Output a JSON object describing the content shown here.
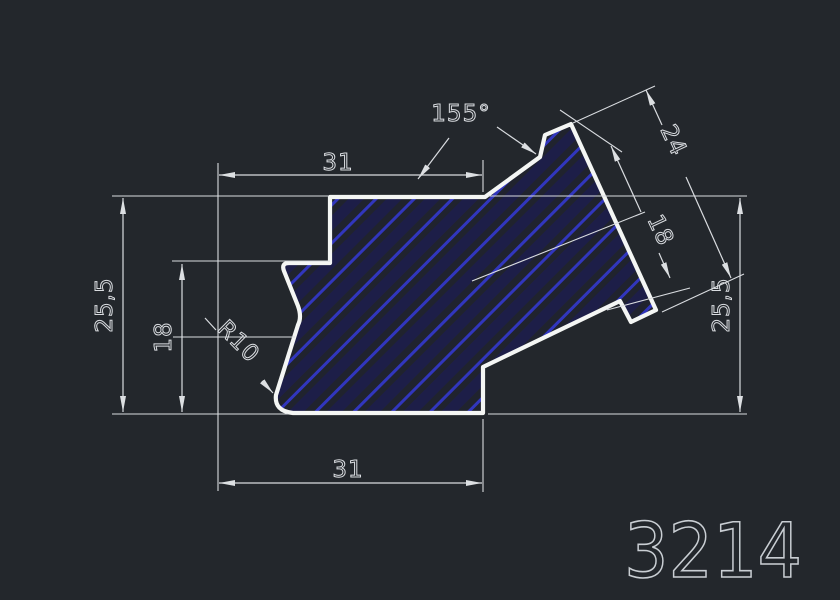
{
  "drawing": {
    "part_number": "3214",
    "annotations": {
      "top_width": "31",
      "bottom_width": "31",
      "left_height": "25,5",
      "right_height": "25,5",
      "notch_height": "18",
      "flange_outer_length": "24",
      "flange_inner_length": "18",
      "bend_angle": "155°",
      "fillet_radius": "R10"
    },
    "colors": {
      "background": "#23272c",
      "profile_outline": "#f4f6f4",
      "dimension_lines": "#d9dce0",
      "hatch_line": "#3136bd",
      "hatch_band": "#1d1e48",
      "part_number_text": "#c9ced3"
    }
  }
}
